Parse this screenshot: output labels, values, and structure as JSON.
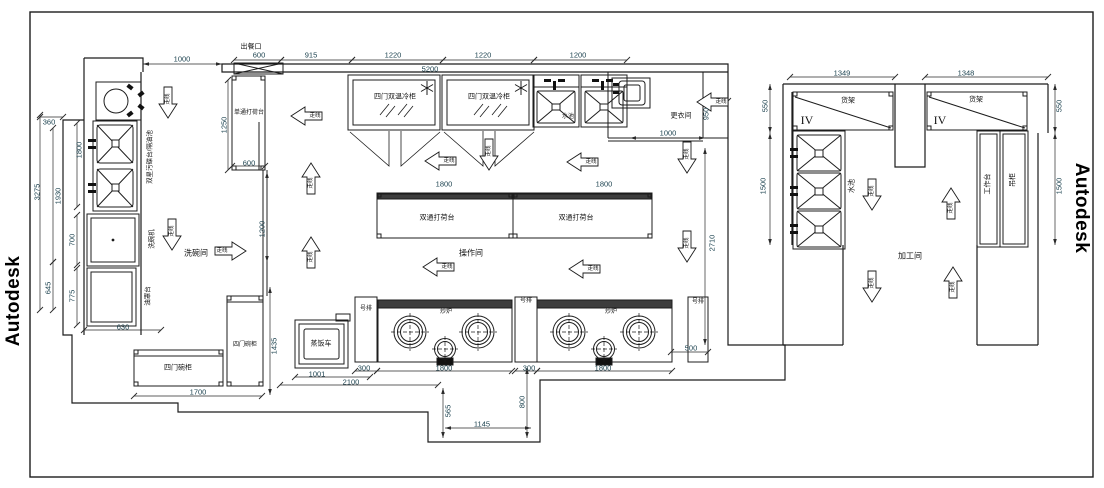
{
  "watermark": {
    "text": "Autodesk"
  },
  "colors": {
    "line": "#1c1c1c",
    "dim_text": "#1d4350",
    "cn_text": "#141414"
  },
  "labels": [
    {
      "n": "label-serving-window",
      "t": "出餐口",
      "x": 251,
      "y": 47,
      "c": "c7"
    },
    {
      "n": "dim-600-top",
      "t": "600",
      "x": 259,
      "y": 55,
      "c": "d"
    },
    {
      "n": "dim-915",
      "t": "915",
      "x": 311,
      "y": 55,
      "c": "d"
    },
    {
      "n": "dim-1220-a",
      "t": "1220",
      "x": 393,
      "y": 55,
      "c": "d"
    },
    {
      "n": "dim-1220-b",
      "t": "1220",
      "x": 483,
      "y": 55,
      "c": "d"
    },
    {
      "n": "dim-1200-top",
      "t": "1200",
      "x": 578,
      "y": 55,
      "c": "d"
    },
    {
      "n": "dim-5200",
      "t": "5200",
      "x": 430,
      "y": 69,
      "c": "d"
    },
    {
      "n": "dim-1000-topleft",
      "t": "1000",
      "x": 182,
      "y": 59,
      "c": "d"
    },
    {
      "n": "dim-360",
      "t": "360",
      "x": 49,
      "y": 122,
      "c": "d"
    },
    {
      "n": "dim-1800-left",
      "t": "1800",
      "x": 79,
      "y": 150,
      "r": -90,
      "c": "d"
    },
    {
      "n": "dim-1930",
      "t": "1930",
      "x": 58,
      "y": 196,
      "r": -90,
      "c": "d"
    },
    {
      "n": "dim-3275",
      "t": "3275",
      "x": 37,
      "y": 192,
      "r": -90,
      "c": "d"
    },
    {
      "n": "dim-700",
      "t": "700",
      "x": 72,
      "y": 240,
      "r": -90,
      "c": "d"
    },
    {
      "n": "dim-775",
      "t": "775",
      "x": 72,
      "y": 296,
      "r": -90,
      "c": "d"
    },
    {
      "n": "dim-645",
      "t": "645",
      "x": 48,
      "y": 288,
      "r": -90,
      "c": "d"
    },
    {
      "n": "dim-630",
      "t": "630",
      "x": 123,
      "y": 327,
      "c": "d"
    },
    {
      "n": "equip-dirty-dish-table",
      "t": "双星污碟台/隔油池",
      "x": 150,
      "y": 157,
      "r": -90,
      "c": "c65"
    },
    {
      "n": "equip-dishwasher",
      "t": "洗碗机",
      "x": 152,
      "y": 239,
      "r": -90,
      "c": "c65"
    },
    {
      "n": "equip-oil-hood-table",
      "t": "油罩台",
      "x": 148,
      "y": 296,
      "r": -90,
      "c": "c65"
    },
    {
      "n": "room-dishwash",
      "t": "洗碗间",
      "x": 196,
      "y": 253,
      "c": "c8"
    },
    {
      "n": "equip-dish-cabinet-h",
      "t": "四门碗柜",
      "x": 178,
      "y": 368,
      "c": "c7"
    },
    {
      "n": "equip-dish-cabinet-v",
      "t": "四门碗柜",
      "x": 245,
      "y": 345,
      "c": "c6"
    },
    {
      "n": "dim-1700",
      "t": "1700",
      "x": 198,
      "y": 392,
      "c": "d"
    },
    {
      "n": "dim-1435",
      "t": "1435",
      "x": 274,
      "y": 346,
      "r": -90,
      "c": "d"
    },
    {
      "n": "equip-rice-steamer",
      "t": "蒸饭车",
      "x": 321,
      "y": 344,
      "c": "c7"
    },
    {
      "n": "dim-1001",
      "t": "1001",
      "x": 317,
      "y": 374,
      "c": "d"
    },
    {
      "n": "dim-2100",
      "t": "2100",
      "x": 351,
      "y": 382,
      "c": "d"
    },
    {
      "n": "dim-300-a",
      "t": "300",
      "x": 364,
      "y": 368,
      "c": "d"
    },
    {
      "n": "dim-1800-a",
      "t": "1800",
      "x": 444,
      "y": 368,
      "c": "d"
    },
    {
      "n": "dim-300-b",
      "t": "300",
      "x": 529,
      "y": 368,
      "c": "d"
    },
    {
      "n": "dim-1800-b",
      "t": "1800",
      "x": 603,
      "y": 368,
      "c": "d"
    },
    {
      "n": "dim-500",
      "t": "500",
      "x": 691,
      "y": 348,
      "c": "d"
    },
    {
      "n": "dim-565",
      "t": "565",
      "x": 448,
      "y": 411,
      "r": -90,
      "c": "d"
    },
    {
      "n": "dim-1145",
      "t": "1145",
      "x": 482,
      "y": 424,
      "c": "d"
    },
    {
      "n": "dim-800",
      "t": "800",
      "x": 522,
      "y": 402,
      "r": -90,
      "c": "d"
    },
    {
      "n": "equip-single-pass-table",
      "t": "单通打荷台",
      "x": 249,
      "y": 113,
      "c": "c6"
    },
    {
      "n": "dim-1250",
      "t": "1250",
      "x": 224,
      "y": 125,
      "r": -90,
      "c": "d"
    },
    {
      "n": "dim-600-mid",
      "t": "600",
      "x": 249,
      "y": 163,
      "c": "d"
    },
    {
      "n": "dim-1200-v",
      "t": "1200",
      "x": 262,
      "y": 229,
      "r": -90,
      "c": "d"
    },
    {
      "n": "equip-fridge-1",
      "t": "四门双温冷柜",
      "x": 395,
      "y": 97,
      "c": "c7"
    },
    {
      "n": "equip-fridge-2",
      "t": "四门双温冷柜",
      "x": 489,
      "y": 97,
      "c": "c7"
    },
    {
      "n": "equip-sink-small",
      "t": "水池",
      "x": 568,
      "y": 117,
      "c": "c6"
    },
    {
      "n": "room-changing",
      "t": "更衣间",
      "x": 681,
      "y": 116,
      "c": "c7"
    },
    {
      "n": "dim-1000-changing",
      "t": "1000",
      "x": 668,
      "y": 133,
      "c": "d"
    },
    {
      "n": "dim-950",
      "t": "950",
      "x": 706,
      "y": 114,
      "r": -90,
      "c": "d"
    },
    {
      "n": "dim-2710",
      "t": "2710",
      "x": 712,
      "y": 243,
      "r": -90,
      "c": "d"
    },
    {
      "n": "dim-1800-c",
      "t": "1800",
      "x": 444,
      "y": 184,
      "c": "d"
    },
    {
      "n": "dim-1800-d",
      "t": "1800",
      "x": 604,
      "y": 184,
      "c": "d"
    },
    {
      "n": "equip-double-pass-table-1",
      "t": "双通打荷台",
      "x": 437,
      "y": 218,
      "c": "c7"
    },
    {
      "n": "equip-double-pass-table-2",
      "t": "双通打荷台",
      "x": 576,
      "y": 218,
      "c": "c7"
    },
    {
      "n": "room-operation",
      "t": "操作间",
      "x": 471,
      "y": 253,
      "c": "c8"
    },
    {
      "n": "equip-side-table-1",
      "t": "号排",
      "x": 366,
      "y": 309,
      "c": "c6"
    },
    {
      "n": "equip-side-table-2",
      "t": "号排",
      "x": 526,
      "y": 301,
      "c": "c6"
    },
    {
      "n": "equip-side-table-3",
      "t": "号排",
      "x": 698,
      "y": 302,
      "c": "c6"
    },
    {
      "n": "equip-wok-range-1",
      "t": "炒炉",
      "x": 446,
      "y": 312,
      "c": "c6"
    },
    {
      "n": "equip-wok-range-2",
      "t": "炒炉",
      "x": 611,
      "y": 312,
      "c": "c6"
    },
    {
      "n": "dim-1349",
      "t": "1349",
      "x": 842,
      "y": 73,
      "c": "d"
    },
    {
      "n": "dim-1348",
      "t": "1348",
      "x": 966,
      "y": 73,
      "c": "d"
    },
    {
      "n": "equip-shelf-1",
      "t": "货架",
      "x": 848,
      "y": 101,
      "c": "c7"
    },
    {
      "n": "equip-shelf-2",
      "t": "货架",
      "x": 976,
      "y": 100,
      "c": "c7"
    },
    {
      "n": "label-roman-iv-1",
      "t": "IV",
      "x": 807,
      "y": 120,
      "c": "sf"
    },
    {
      "n": "label-roman-iv-2",
      "t": "IV",
      "x": 940,
      "y": 120,
      "c": "sf"
    },
    {
      "n": "dim-550-l",
      "t": "550",
      "x": 765,
      "y": 106,
      "r": -90,
      "c": "d"
    },
    {
      "n": "dim-1500-l",
      "t": "1500",
      "x": 763,
      "y": 186,
      "r": -90,
      "c": "d"
    },
    {
      "n": "dim-550-r",
      "t": "550",
      "x": 1059,
      "y": 106,
      "r": -90,
      "c": "d"
    },
    {
      "n": "dim-1500-r",
      "t": "1500",
      "x": 1059,
      "y": 186,
      "r": -90,
      "c": "d"
    },
    {
      "n": "equip-sink-right",
      "t": "水池",
      "x": 852,
      "y": 186,
      "r": -90,
      "c": "c7"
    },
    {
      "n": "equip-worktable",
      "t": "工作台",
      "x": 988,
      "y": 184,
      "r": -90,
      "c": "c7"
    },
    {
      "n": "equip-hanging-cabinet",
      "t": "吊柜",
      "x": 1013,
      "y": 180,
      "r": -90,
      "c": "c7"
    },
    {
      "n": "room-processing",
      "t": "加工间",
      "x": 910,
      "y": 256,
      "c": "c8"
    }
  ],
  "arrows": [
    {
      "x": 168,
      "y": 103,
      "d": "down",
      "label": "走线"
    },
    {
      "x": 306,
      "y": 116,
      "d": "left",
      "label": "走线"
    },
    {
      "x": 311,
      "y": 178,
      "d": "up",
      "label": "走线"
    },
    {
      "x": 172,
      "y": 235,
      "d": "down",
      "label": "走线"
    },
    {
      "x": 231,
      "y": 251,
      "d": "right",
      "label": "走线"
    },
    {
      "x": 311,
      "y": 252,
      "d": "up",
      "label": "走线"
    },
    {
      "x": 440,
      "y": 161,
      "d": "left",
      "label": "走线"
    },
    {
      "x": 489,
      "y": 155,
      "d": "down",
      "label": "走线"
    },
    {
      "x": 582,
      "y": 162,
      "d": "left",
      "label": "走线"
    },
    {
      "x": 712,
      "y": 102,
      "d": "left",
      "label": "走线"
    },
    {
      "x": 687,
      "y": 158,
      "d": "down",
      "label": "走线"
    },
    {
      "x": 687,
      "y": 247,
      "d": "down",
      "label": "走线"
    },
    {
      "x": 438,
      "y": 267,
      "d": "left",
      "label": "走线"
    },
    {
      "x": 584,
      "y": 269,
      "d": "left",
      "label": "走线"
    },
    {
      "x": 872,
      "y": 195,
      "d": "down",
      "label": "走线"
    },
    {
      "x": 951,
      "y": 203,
      "d": "up",
      "label": "走线"
    },
    {
      "x": 872,
      "y": 287,
      "d": "down",
      "label": "走线"
    },
    {
      "x": 953,
      "y": 282,
      "d": "up",
      "label": "走线"
    }
  ]
}
